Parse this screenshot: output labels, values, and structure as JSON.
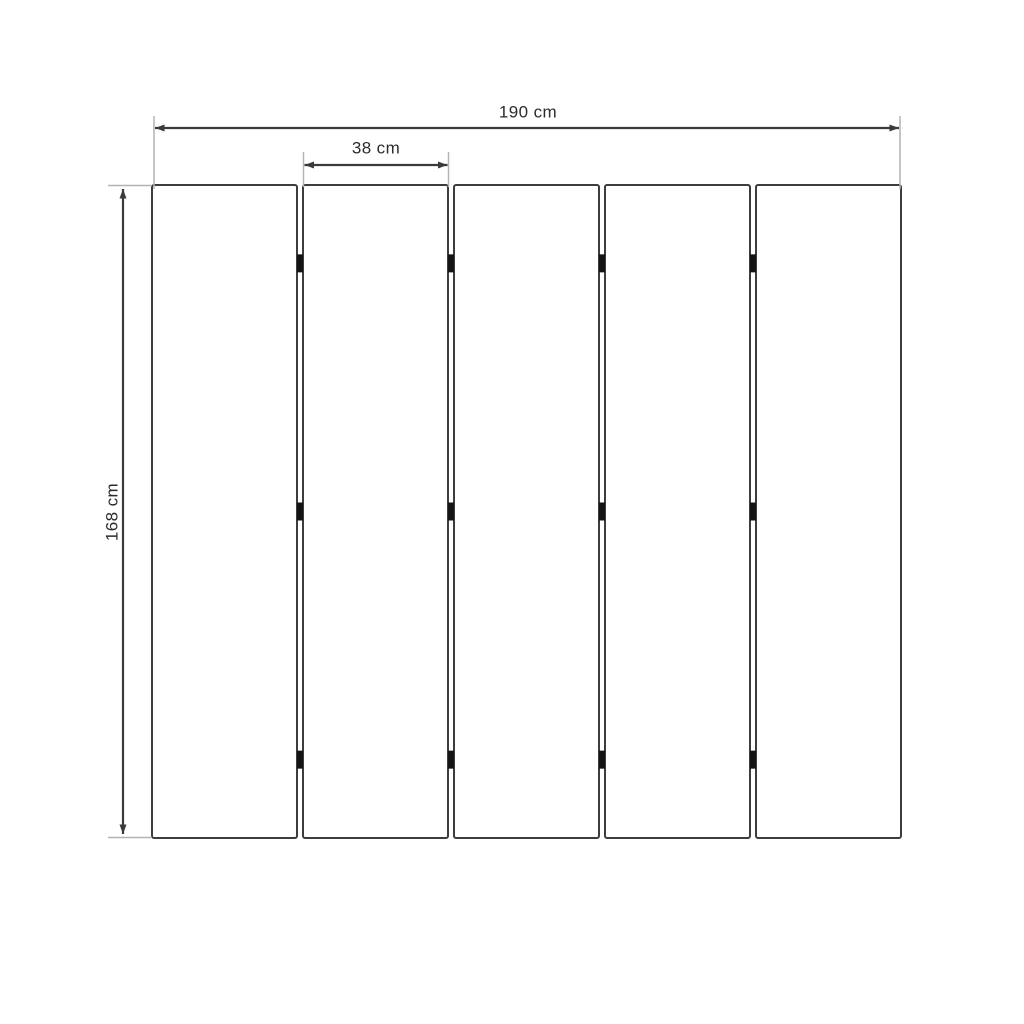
{
  "page": {
    "background": "#ffffff"
  },
  "diagram": {
    "type": "dimensioned-technical-drawing",
    "panel_count": 5,
    "joint_count": 4,
    "hinges_per_joint": 3,
    "colors": {
      "background": "#ffffff",
      "panel_stroke": "#3d3d3d",
      "panel_fill": "#ffffff",
      "dimension_line": "#3a3a3a",
      "extension_line": "#b3b3b3",
      "hinge": "#141414",
      "label_text": "#2b2b2b"
    },
    "dimensions": {
      "total_width": {
        "label": "190 cm"
      },
      "panel_width": {
        "label": "38 cm"
      },
      "height": {
        "label": "168 cm"
      }
    },
    "layout": {
      "left": 152,
      "top": 185,
      "right": 901,
      "bottom": 838,
      "gap": 6,
      "corner_radius": 2,
      "hinge_fractions": [
        0.12,
        0.5,
        0.88
      ],
      "hinge_width": 6,
      "hinge_height": 18
    }
  }
}
